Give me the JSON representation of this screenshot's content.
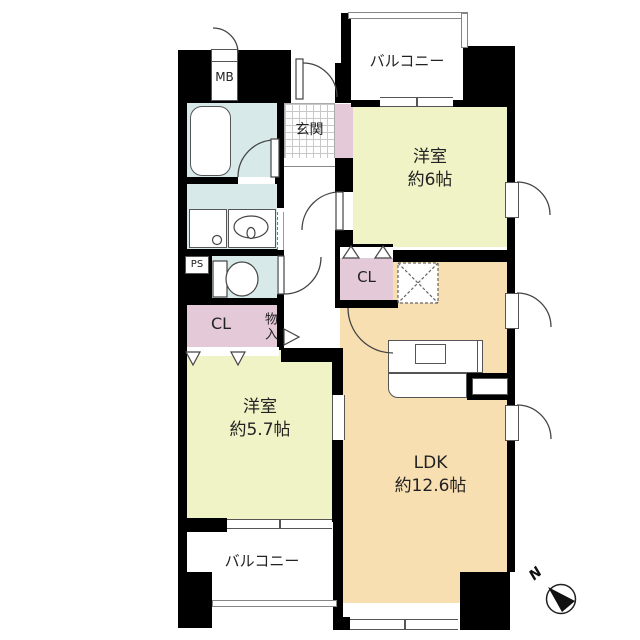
{
  "colors": {
    "wall": "#000000",
    "room-yellow": "#eff3c5",
    "ldk-peach": "#f8dfb2",
    "closet-pink": "#e4c9d8",
    "wet-blue": "#d7e9e9"
  },
  "labels": {
    "balcony_top": "バルコニー",
    "mb": "MB",
    "genkan": "玄関",
    "bedroom1_name": "洋室",
    "bedroom1_size": "約6帖",
    "cl_upper": "CL",
    "ps": "PS",
    "cl_lower": "CL",
    "storage": "物入",
    "bedroom2_name": "洋室",
    "bedroom2_size": "約5.7帖",
    "ldk_name": "LDK",
    "ldk_size": "約12.6帖",
    "balcony_bottom": "バルコニー",
    "compass_north": "N"
  }
}
